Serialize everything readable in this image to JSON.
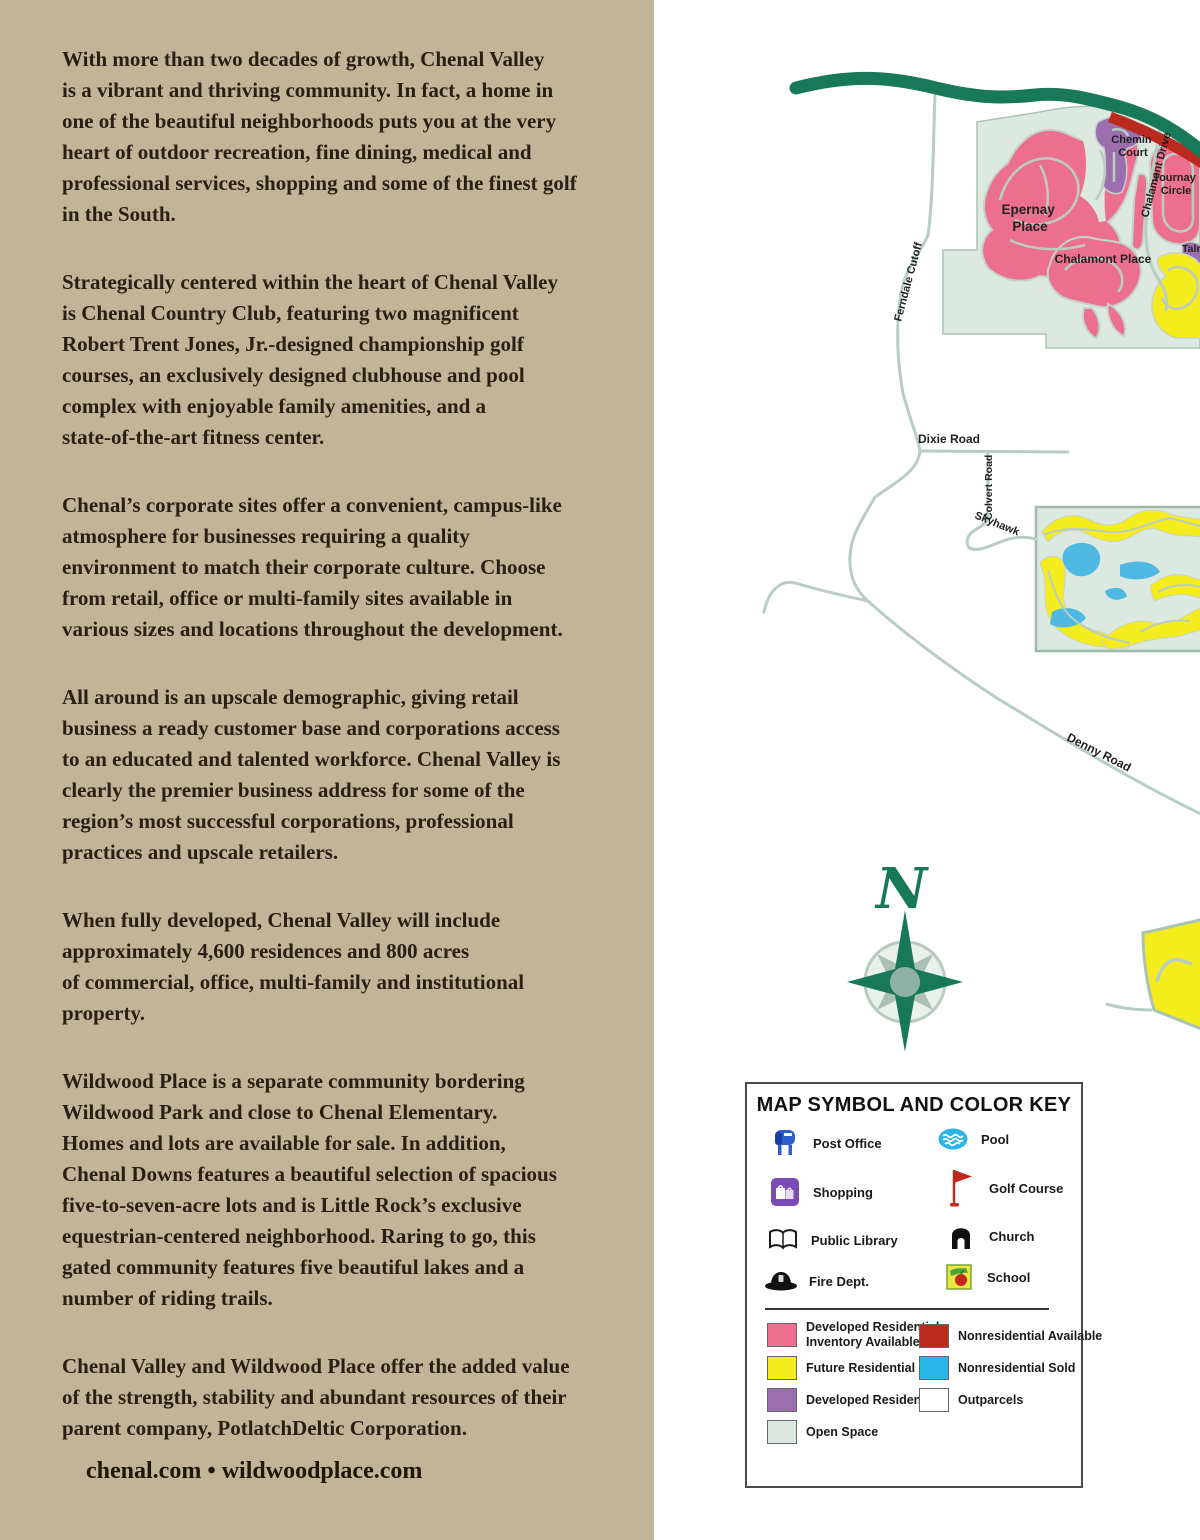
{
  "left_panel": {
    "paragraphs": [
      "With more than two decades of growth, Chenal Valley\nis a vibrant and thriving community. In fact, a home in\none of the beautiful neighborhoods puts you at the very\nheart of outdoor recreation, fine dining, medical and\nprofessional services, shopping and some of the finest golf\nin the South.",
      "Strategically centered within the heart of Chenal Valley\nis Chenal Country Club, featuring two magnificent\nRobert Trent Jones, Jr.-designed championship golf\ncourses, an exclusively designed clubhouse and pool\ncomplex with enjoyable family amenities, and a\nstate-of-the-art fitness center.",
      "Chenal’s corporate sites offer a convenient, campus-like\natmosphere for businesses requiring a quality\nenvironment to match their corporate culture. Choose\nfrom retail, office or multi-family sites available in\nvarious sizes and locations throughout the development.",
      "All around is an upscale demographic, giving retail\nbusiness a ready customer base and corporations access\nto an educated and talented workforce. Chenal Valley is\nclearly the premier business address for some of the\nregion’s most successful corporations, professional\npractices and upscale retailers.",
      "When fully developed, Chenal Valley will include\napproximately 4,600 residences and 800 acres\nof commercial, office, multi-family and institutional\nproperty.",
      "Wildwood Place is a separate community bordering\nWildwood Park and close to Chenal Elementary.\nHomes and lots are available for sale. In addition,\nChenal Downs features a beautiful selection of spacious\nfive-to-seven-acre lots and is Little Rock’s exclusive\nequestrian-centered neighborhood. Raring to go, this\ngated community features five beautiful lakes and a\nnumber of riding trails.",
      "Chenal Valley and Wildwood Place offer the added value\nof the strength, stability and abundant resources of their\nparent company, PotlatchDeltic Corporation."
    ],
    "footer": "chenal.com • wildwoodplace.com"
  },
  "map": {
    "compass_letter": "N",
    "road_labels": {
      "ferndale": "Ferndale  Cutoff",
      "dixie": "Dixie Road",
      "colvert": "Colvert Road",
      "skyhawk": "Skyhawk",
      "denny": "Denny Road",
      "chalamont_drive": "Chalamont Drive"
    },
    "area_labels": {
      "chemin1": "Chemin",
      "chemin2": "Court",
      "tournay1": "Tournay",
      "tournay2": "Circle",
      "epernay1": "Epernay",
      "epernay2": "Place",
      "chalamont_place": "Chalamont Place",
      "talm": "Talm"
    },
    "colors": {
      "highway": "#17795A",
      "road": "#B9CDC3",
      "open_space": "#DCE9E0",
      "parcel_outline": "#C2D2C8",
      "developed_residential_inventory": "#EC6F90",
      "future_residential": "#F5EC1D",
      "developed_residential": "#9B6FAE",
      "nonresidential_available": "#BB2A1F",
      "nonresidential_sold": "#2AB6E8",
      "water": "#4FB9E4",
      "compass_primary": "#17795A",
      "compass_secondary": "#A9C0B3"
    }
  },
  "legend": {
    "title": "MAP SYMBOL AND COLOR KEY",
    "symbols": [
      {
        "icon": "post-office-icon",
        "label": "Post Office"
      },
      {
        "icon": "shopping-icon",
        "label": "Shopping"
      },
      {
        "icon": "public-library-icon",
        "label": "Public Library"
      },
      {
        "icon": "fire-dept-icon",
        "label": "Fire Dept."
      },
      {
        "icon": "pool-icon",
        "label": "Pool"
      },
      {
        "icon": "golf-course-icon",
        "label": "Golf Course"
      },
      {
        "icon": "church-icon",
        "label": "Church"
      },
      {
        "icon": "school-icon",
        "label": "School"
      }
    ],
    "color_items": [
      {
        "hex": "#EC6F90",
        "lines": [
          "Developed Residential",
          "Inventory Available"
        ]
      },
      {
        "hex": "#F5EC1D",
        "lines": [
          "Future Residential"
        ]
      },
      {
        "hex": "#9B6FAE",
        "lines": [
          "Developed Residential"
        ]
      },
      {
        "hex": "#DCE9E0",
        "lines": [
          "Open Space"
        ]
      },
      {
        "hex": "#BB2A1F",
        "lines": [
          "Nonresidential Available"
        ]
      },
      {
        "hex": "#2AB6E8",
        "lines": [
          "Nonresidential Sold"
        ]
      },
      {
        "hex": "#FFFFFF",
        "lines": [
          "Outparcels"
        ]
      }
    ]
  }
}
